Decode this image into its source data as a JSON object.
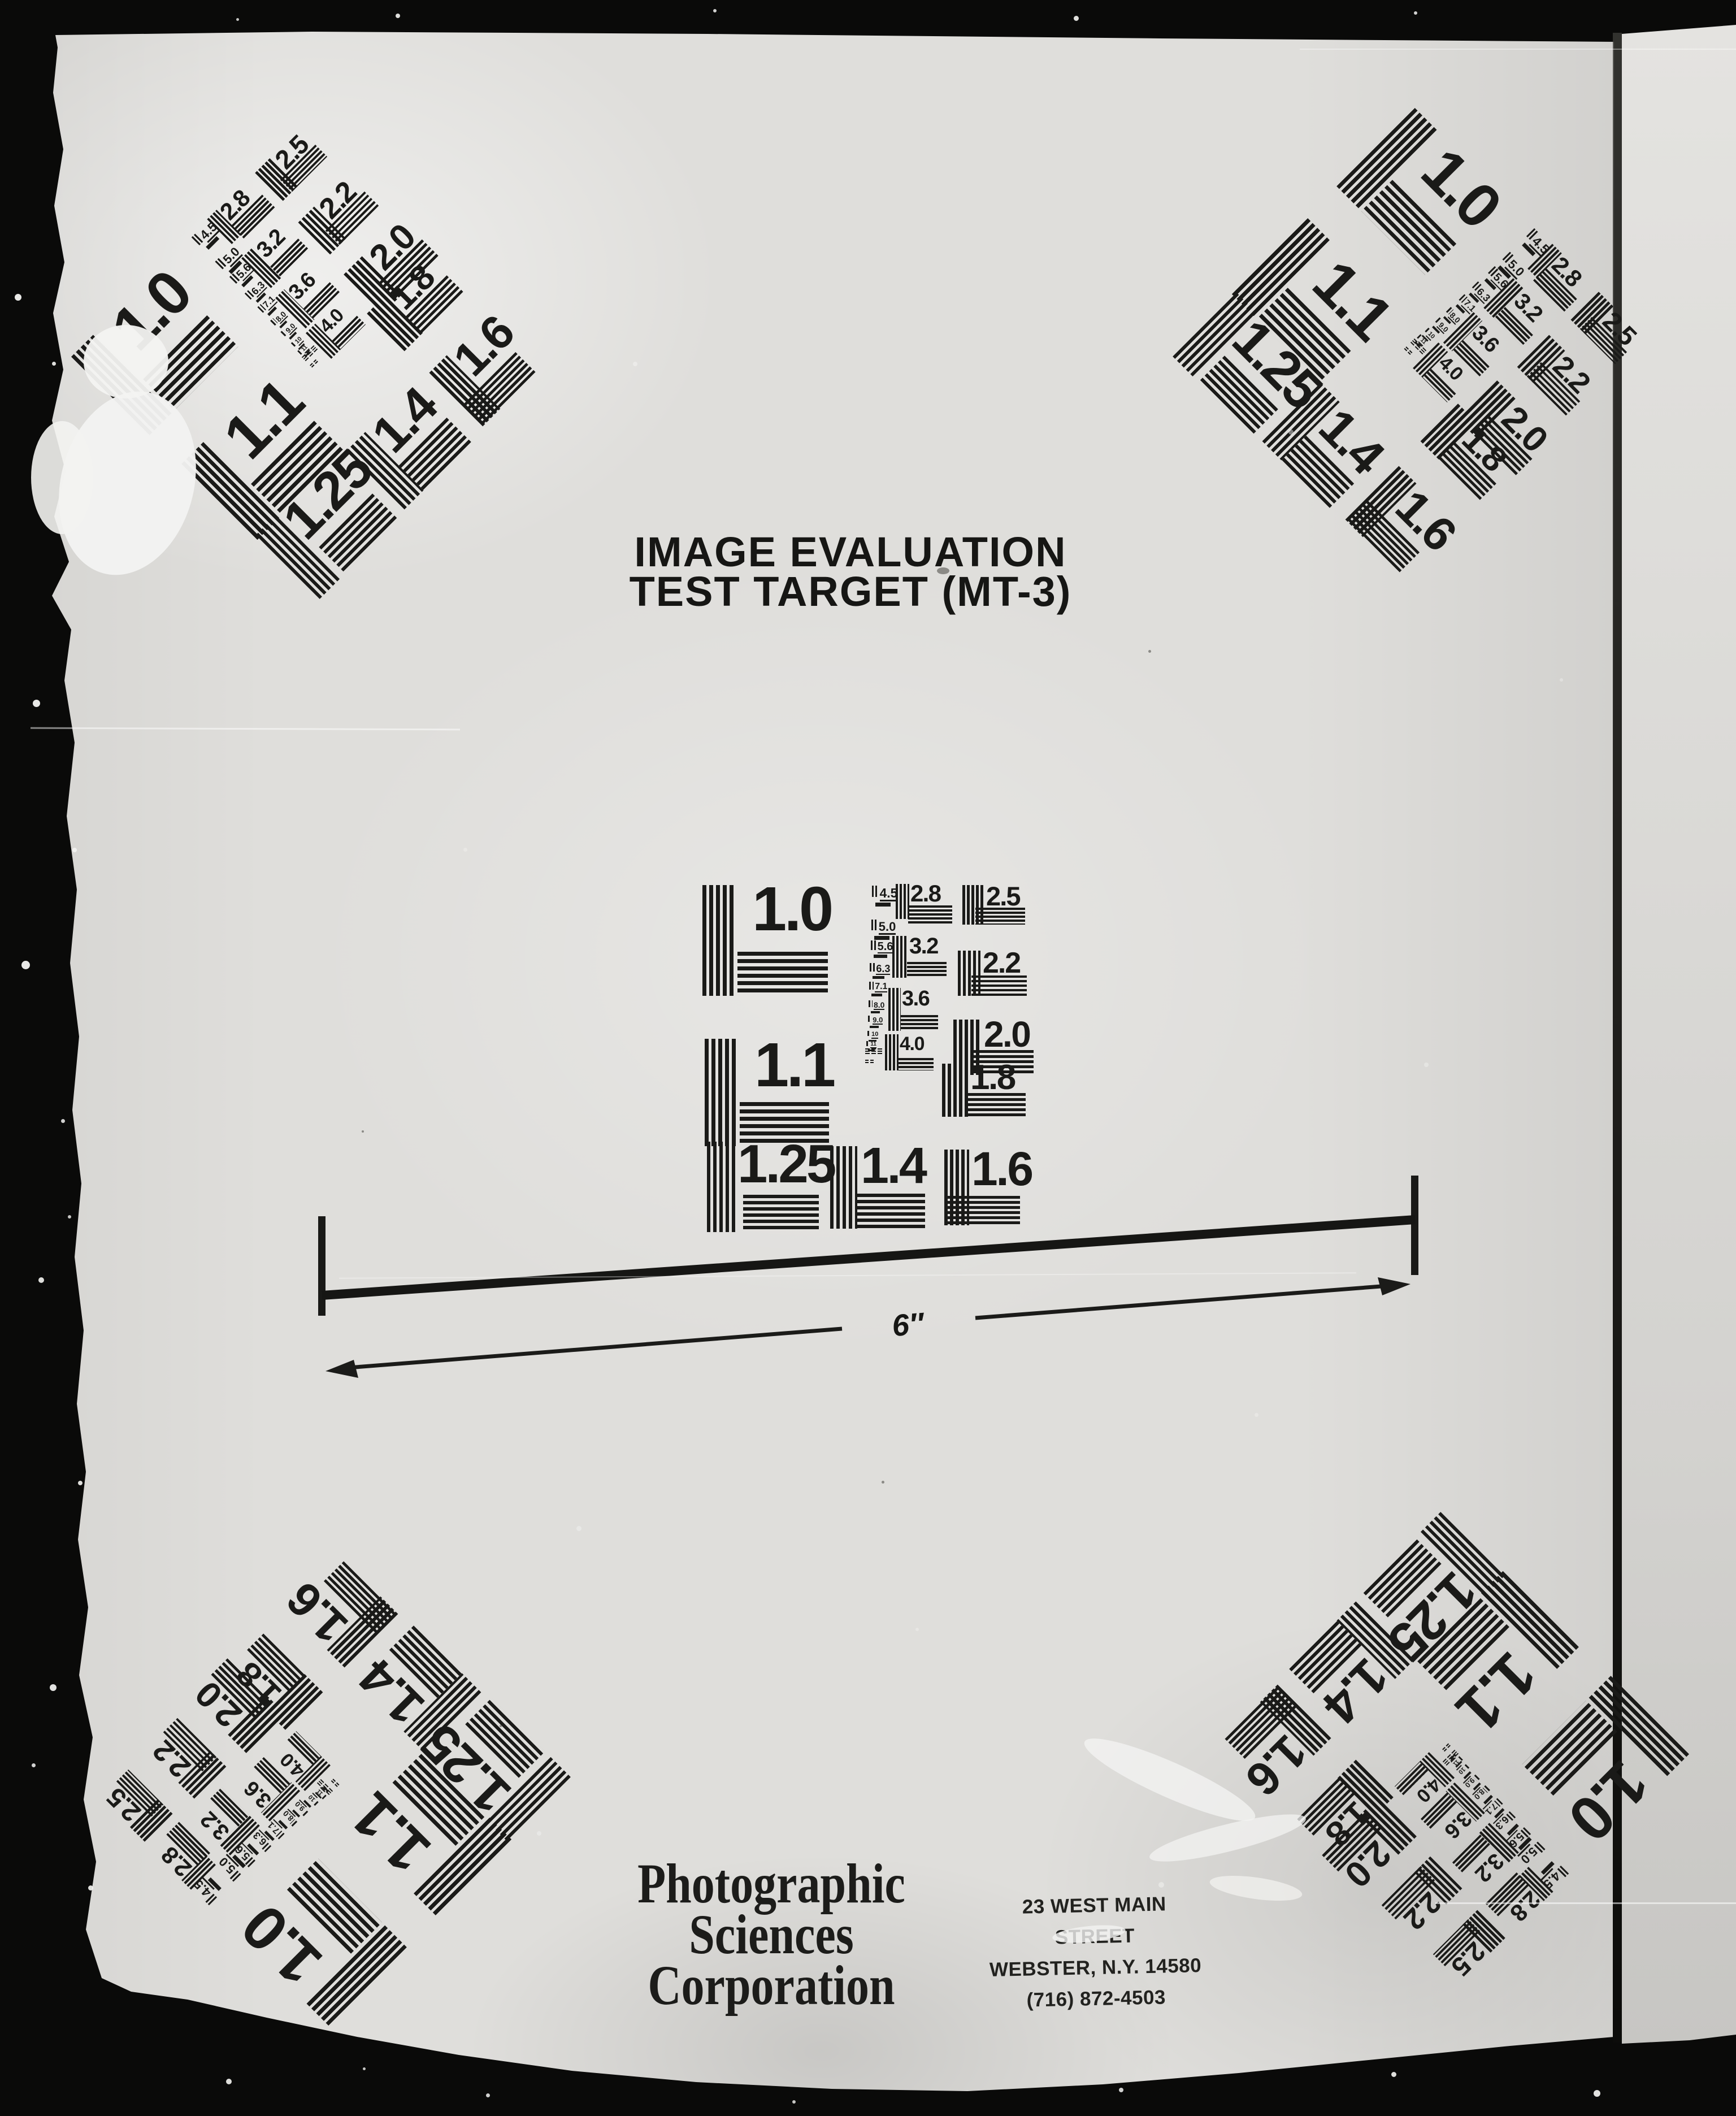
{
  "title": {
    "line1": "IMAGE EVALUATION",
    "line2": "TEST TARGET (MT-3)"
  },
  "resolution_target": {
    "block_values": [
      "1.0",
      "1.1",
      "1.25",
      "1.4",
      "1.6",
      "1.8",
      "2.0",
      "2.2",
      "2.5",
      "2.8",
      "3.2",
      "3.6",
      "4.0"
    ],
    "ladder_values": [
      "4.5",
      "5.0",
      "5.6",
      "6.3",
      "7.1",
      "8.0",
      "9.0",
      "10",
      "11"
    ],
    "instances": [
      "center",
      "top-left",
      "top-right",
      "bottom-left",
      "bottom-right"
    ]
  },
  "scale_bar": {
    "label": "6″"
  },
  "footer": {
    "organization": [
      "Photographic",
      "Sciences",
      "Corporation"
    ],
    "address": [
      "23 WEST MAIN STREET",
      "WEBSTER, N.Y. 14580",
      "(716) 872-4503"
    ]
  },
  "colors": {
    "ink": "#1a1a18",
    "paper": "#dfdedb",
    "film_black": "#0a0a09"
  }
}
